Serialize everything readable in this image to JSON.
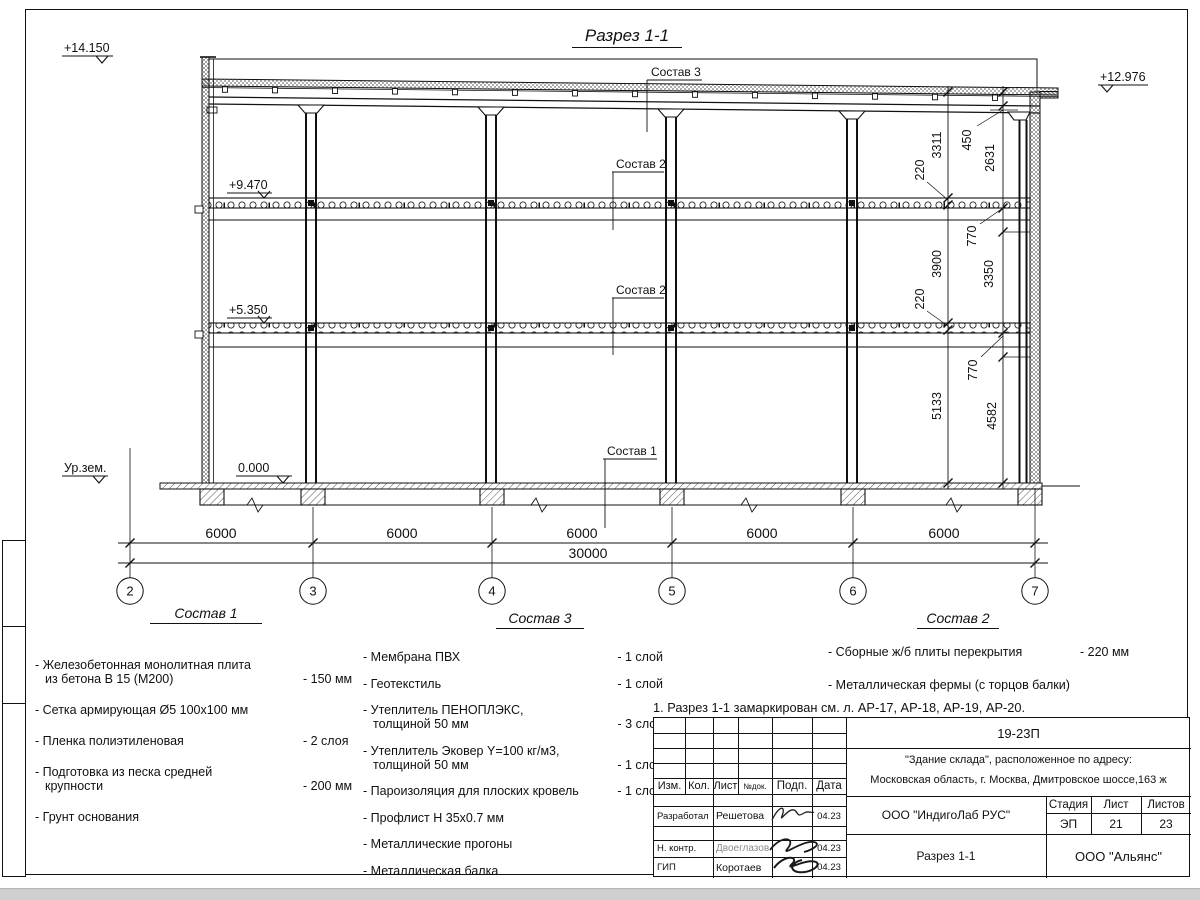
{
  "page": {
    "section_title": "Разрез 1-1",
    "note": "1. Разрез 1-1 замаркирован см. л. АР-17, АР-18, АР-19, АР-20."
  },
  "drawing": {
    "elev_parapet_left": "+14.150",
    "elev_roof_right": "+12.976",
    "elev_slab_upper": "+9.470",
    "elev_slab_lower": "+5.350",
    "elev_floor": "0.000",
    "elev_ground": "Ур.зем.",
    "callout_roof": "Состав 3",
    "callout_slab_upper": "Состав 2",
    "callout_slab_lower": "Состав 2",
    "callout_floor": "Состав 1",
    "dims_right_a": [
      "3311",
      "220",
      "3900",
      "220",
      "5133"
    ],
    "dims_right_b": [
      "450",
      "2631",
      "770",
      "3350",
      "770",
      "4582"
    ],
    "dims_bottom": [
      "6000",
      "6000",
      "6000",
      "6000",
      "6000"
    ],
    "dim_total": "30000",
    "axes": [
      "2",
      "3",
      "4",
      "5",
      "6",
      "7"
    ]
  },
  "legend": {
    "comp1": {
      "title": "Состав 1",
      "items": [
        {
          "name": "- Железобетонная  монолитная плита\nиз бетона В 15 (М200)",
          "value": "- 150 мм"
        },
        {
          "name": "- Сетка армирующая Ø5 100x100 мм",
          "value": ""
        },
        {
          "name": "- Пленка полиэтиленовая",
          "value": "-  2 слоя"
        },
        {
          "name": "- Подготовка из песка средней\nкрупности",
          "value": "- 200 мм"
        },
        {
          "name": "- Грунт основания",
          "value": ""
        }
      ]
    },
    "comp3": {
      "title": "Состав 3",
      "items": [
        {
          "name": "- Мембрана ПВХ",
          "value": "- 1 слой"
        },
        {
          "name": "- Геотекстиль",
          "value": "- 1 слой"
        },
        {
          "name": "- Утеплитель ПЕНОПЛЭКС,\nтолщиной 50 мм",
          "value": "- 3 слоя"
        },
        {
          "name": "- Утеплитель Эковер Y=100 кг/м3,\nтолщиной 50 мм",
          "value": "- 1 слой"
        },
        {
          "name": "- Пароизоляция для плоских кровель",
          "value": "- 1 слой"
        },
        {
          "name": "- Профлист Н 35х0.7 мм",
          "value": ""
        },
        {
          "name": "- Металлические прогоны",
          "value": ""
        },
        {
          "name": "- Металлическая балка",
          "value": ""
        }
      ]
    },
    "comp2": {
      "title": "Состав 2",
      "items": [
        {
          "name": "- Сборные ж/б плиты перекрытия",
          "value": "- 220 мм"
        },
        {
          "name": "- Металлическая фермы (с торцов балки)",
          "value": ""
        }
      ]
    }
  },
  "stamp": {
    "doc_code": "19-23П",
    "object_line1": "\"Здание склада\", расположенное по адресу:",
    "object_line2": "Московская область, г. Москва, Дмитровское шоссе,163 ж",
    "cols": {
      "izm": "Изм.",
      "kol": "Кол.",
      "list": "Лист",
      "ndok": "№док.",
      "podp": "Подп.",
      "data": "Дата"
    },
    "rows": [
      {
        "role": "Разработал",
        "name": "Решетова",
        "date": "04.23"
      },
      {
        "role": "Н. контр.",
        "name": "Двоеглазов",
        "date": "04.23"
      },
      {
        "role": "ГИП",
        "name": "Коротаев",
        "date": "04.23"
      }
    ],
    "company": "ООО \"ИндигоЛаб РУС\"",
    "stage_label": "Стадия",
    "sheet_label": "Лист",
    "sheets_label": "Листов",
    "stage": "ЭП",
    "sheet_no": "21",
    "sheets_total": "23",
    "drawing_name": "Разрез 1-1",
    "org": "ООО \"Альянс\""
  }
}
